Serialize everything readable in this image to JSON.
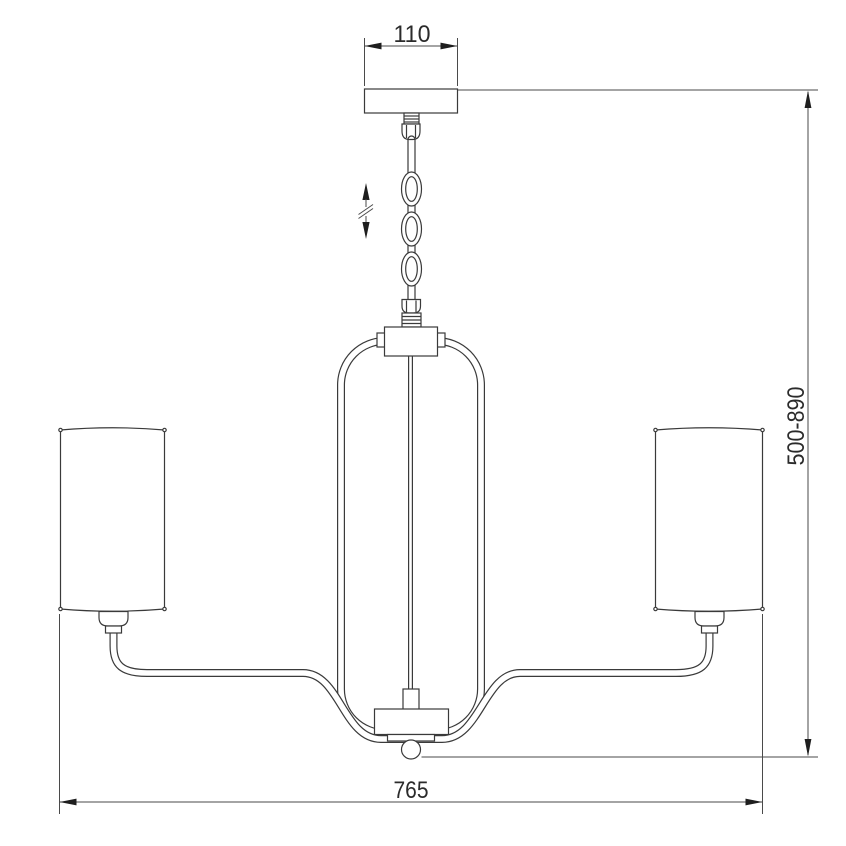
{
  "drawing": {
    "kind": "technical-dimension-drawing",
    "subject": "chandelier with chain suspension, arched frame and two cylindrical shades, side elevation",
    "background_color": "#ffffff",
    "line_color": "#3a3a3a",
    "dimension_color": "#4a4a4a",
    "dimensions": {
      "canopy_width": "110",
      "overall_height": "500-890",
      "overall_width": "765"
    },
    "symbols": {
      "height_adjustment": "double-headed vertical arrow with break marks (adjustable chain length)"
    },
    "components": [
      "ceiling-canopy",
      "threaded-nipple",
      "chain-coupler",
      "suspension-chain",
      "chain-socket",
      "center-hub",
      "arched-frame-tube",
      "center-rod",
      "center-bowl",
      "ball-finial",
      "left-arm",
      "right-arm",
      "left-cylindrical-shade",
      "right-cylindrical-shade",
      "shade-holders"
    ]
  }
}
